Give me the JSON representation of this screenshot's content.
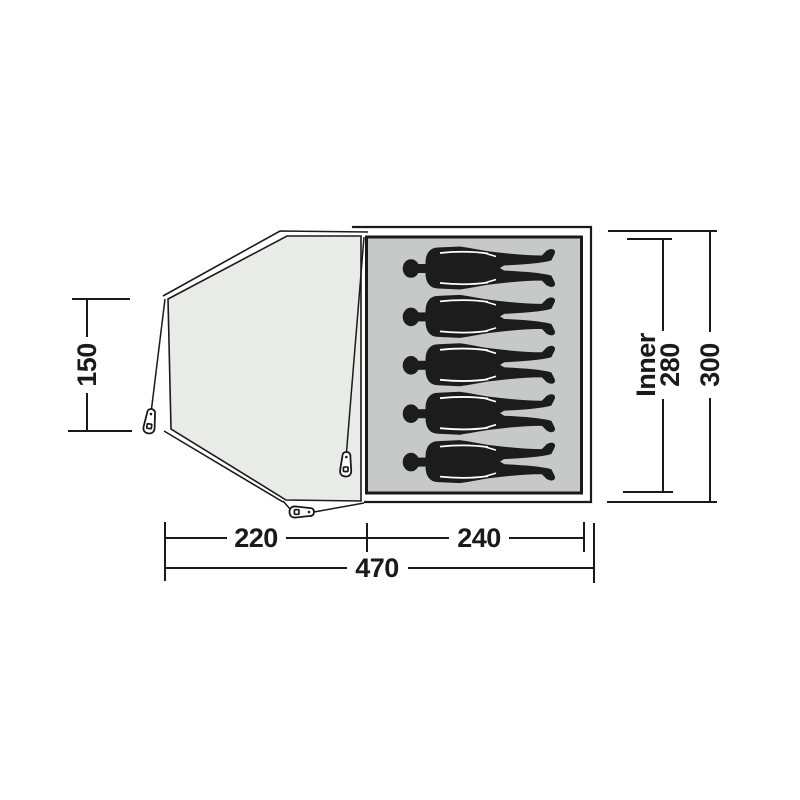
{
  "diagram": {
    "type": "tent-floorplan-top-view",
    "capacity_persons": 5,
    "dimensions": {
      "left_height": "150",
      "inner_label": "Inner",
      "inner_depth": "280",
      "outer_depth": "300",
      "bottom_front": "220",
      "bottom_inner": "240",
      "bottom_total": "470"
    },
    "colors": {
      "outline": "#1a1a1a",
      "vestibule_fill": "#e9ebe9",
      "inner_fill": "#c6c9c7",
      "figure_fill": "#1c1c1c",
      "background": "#ffffff"
    }
  }
}
